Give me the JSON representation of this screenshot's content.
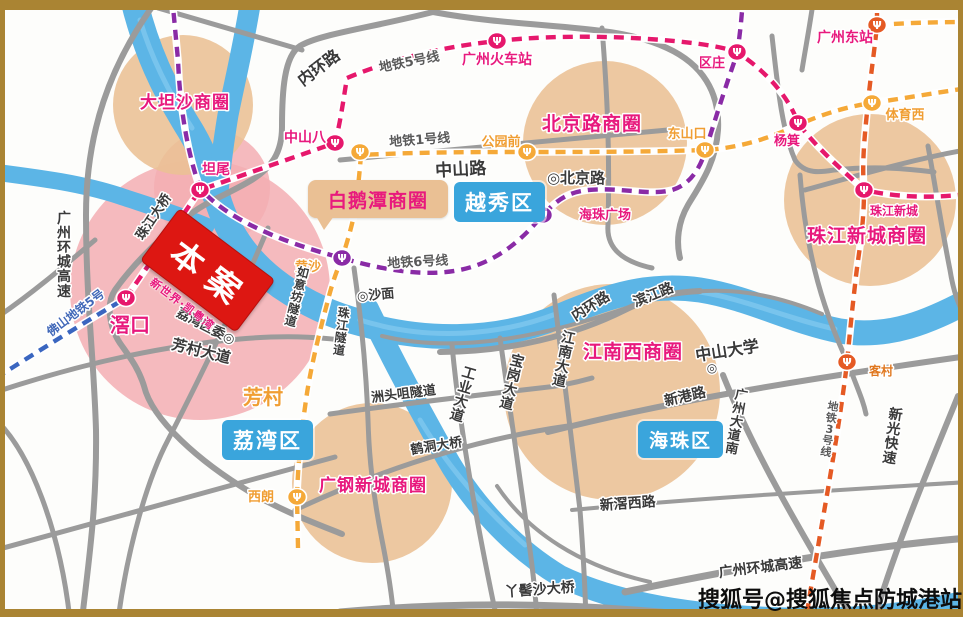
{
  "map": {
    "title_note": "Guangzhou area business-circle location map",
    "watermark": "搜狐号@搜狐焦点防城港站",
    "colors": {
      "frame": "#aa8433",
      "river": "#5cb5e6",
      "river_hi": "#85cbf0",
      "road": "#9b9b9b",
      "circle_tan": "#eac094",
      "circle_pink": "#f3aeb3",
      "pink": "#e8197d",
      "orange": "#f09e33",
      "dorange": "#e07820",
      "blue": "#4168b8",
      "dark": "#3a3a3a",
      "gray": "#5a5a5a",
      "district_box": "#3aa5dc",
      "bubble_tan": "#eac094",
      "project_red": "#dd1712",
      "line1": "#f5a938",
      "line3": "#e55a24",
      "line5": "#e6186c",
      "line6": "#8a2ba6",
      "foshan5": "#3a66c0"
    },
    "project": {
      "label": "本案",
      "sub_label": "新世界·凯粤湾"
    },
    "bubble": {
      "label": "白鹅潭商圈"
    },
    "districts": [
      {
        "label": "越秀区"
      },
      {
        "label": "荔湾区"
      },
      {
        "label": "海珠区"
      }
    ],
    "business_circles": [
      {
        "name": "大坦沙商圈",
        "cx": 183,
        "cy": 105,
        "r": 70,
        "tx": 185,
        "ty": 108,
        "fs": 17
      },
      {
        "name": "北京路商圈",
        "cx": 605,
        "cy": 143,
        "r": 82,
        "tx": 592,
        "ty": 130,
        "fs": 19
      },
      {
        "name": "珠江新城商圈",
        "cx": 870,
        "cy": 200,
        "r": 86,
        "tx": 867,
        "ty": 242,
        "fs": 19
      },
      {
        "name": "江南西商圈",
        "cx": 612,
        "cy": 392,
        "r": 108,
        "tx": 633,
        "ty": 358,
        "fs": 19
      },
      {
        "name": "广钢新城商圈",
        "cx": 372,
        "cy": 483,
        "r": 80,
        "tx": 373,
        "ty": 491,
        "fs": 17
      }
    ],
    "pink_zones": [
      {
        "name": "project-zone",
        "cx": 200,
        "cy": 290,
        "r": 130
      },
      {
        "name": "tanwei-zone",
        "cx": 212,
        "cy": 188,
        "r": 58
      }
    ],
    "stations": [
      {
        "name": "滘口",
        "x": 126,
        "y": 298,
        "c": "line5"
      },
      {
        "name": "坦尾",
        "x": 200,
        "y": 190,
        "c": "line5"
      },
      {
        "name": "中山八",
        "x": 335,
        "y": 143,
        "c": "line5"
      },
      {
        "name": "广州火车站",
        "x": 497,
        "y": 41,
        "c": "line5"
      },
      {
        "name": "区庄",
        "x": 737,
        "y": 52,
        "c": "line5"
      },
      {
        "name": "杨箕",
        "x": 798,
        "y": 123,
        "c": "line5"
      },
      {
        "name": "珠江新城",
        "x": 864,
        "y": 190,
        "c": "line5"
      },
      {
        "name": "公园前",
        "x": 527,
        "y": 152,
        "c": "line1"
      },
      {
        "name": "长寿路",
        "x": 360,
        "y": 152,
        "c": "line1"
      },
      {
        "name": "东山口",
        "x": 705,
        "y": 150,
        "c": "line1"
      },
      {
        "name": "体育西",
        "x": 872,
        "y": 103,
        "c": "line1"
      },
      {
        "name": "西朗",
        "x": 297,
        "y": 497,
        "c": "line1"
      },
      {
        "name": "黄沙",
        "x": 342,
        "y": 258,
        "c": "line6"
      },
      {
        "name": "海珠广场",
        "x": 543,
        "y": 215,
        "c": "line6"
      },
      {
        "name": "广州东站",
        "x": 877,
        "y": 25,
        "c": "line3"
      },
      {
        "name": "客村",
        "x": 847,
        "y": 362,
        "c": "line3"
      }
    ],
    "labels": [
      {
        "k": "station",
        "t": "滘口",
        "x": 130,
        "y": 332,
        "fs": 20,
        "c": "pink"
      },
      {
        "k": "station",
        "t": "坦尾",
        "x": 216,
        "y": 174,
        "fs": 14,
        "c": "pink"
      },
      {
        "k": "station",
        "t": "中山八",
        "x": 326,
        "y": 142,
        "fs": 14,
        "c": "pink",
        "a": "end"
      },
      {
        "k": "station",
        "t": "广州火车站",
        "x": 497,
        "y": 64,
        "fs": 14,
        "c": "pink"
      },
      {
        "k": "station",
        "t": "区庄",
        "x": 712,
        "y": 67,
        "fs": 13,
        "c": "pink"
      },
      {
        "k": "station",
        "t": "杨箕",
        "x": 787,
        "y": 145,
        "fs": 13,
        "c": "pink"
      },
      {
        "k": "station",
        "t": "珠江新城",
        "x": 894,
        "y": 215,
        "fs": 12,
        "c": "pink"
      },
      {
        "k": "station",
        "t": "广州东站",
        "x": 845,
        "y": 42,
        "fs": 14,
        "c": "pink"
      },
      {
        "k": "station",
        "t": "海珠广场",
        "x": 579,
        "y": 219,
        "fs": 13,
        "c": "pink",
        "a": "start"
      },
      {
        "k": "station",
        "t": "公园前",
        "x": 501,
        "y": 146,
        "fs": 13,
        "c": "orange"
      },
      {
        "k": "station",
        "t": "东山口",
        "x": 687,
        "y": 138,
        "fs": 13,
        "c": "orange"
      },
      {
        "k": "station",
        "t": "体育西",
        "x": 905,
        "y": 119,
        "fs": 13,
        "c": "orange"
      },
      {
        "k": "station",
        "t": "西朗",
        "x": 274,
        "y": 501,
        "fs": 13,
        "c": "orange",
        "a": "end"
      },
      {
        "k": "station",
        "t": "黄沙",
        "x": 321,
        "y": 271,
        "fs": 13,
        "c": "orange",
        "a": "end"
      },
      {
        "k": "station",
        "t": "客村",
        "x": 869,
        "y": 375,
        "fs": 12,
        "c": "dorange",
        "a": "start"
      },
      {
        "k": "area",
        "t": "芳村",
        "x": 263,
        "y": 404,
        "fs": 20,
        "c": "orange"
      },
      {
        "k": "road",
        "t": "内环路",
        "x": 322,
        "y": 72,
        "r": -37,
        "fs": 16
      },
      {
        "k": "road",
        "t": "中山路",
        "x": 461,
        "y": 175,
        "r": -3,
        "fs": 17
      },
      {
        "k": "road",
        "t": "珠江大桥",
        "x": 157,
        "y": 219,
        "r": -56,
        "fs": 13
      },
      {
        "k": "road",
        "t": "广州环城高速",
        "x": 64,
        "y": 258,
        "v": 1,
        "fs": 14
      },
      {
        "k": "road",
        "t": "如意坊隧道",
        "x": 296,
        "y": 300,
        "v": 1,
        "r": 14,
        "fs": 12
      },
      {
        "k": "road",
        "t": "珠江隧道",
        "x": 341,
        "y": 335,
        "v": 1,
        "r": 7,
        "fs": 12
      },
      {
        "k": "road",
        "t": "芳村大道",
        "x": 200,
        "y": 356,
        "r": 14,
        "fs": 15
      },
      {
        "k": "road",
        "t": "洲头咀隧道",
        "x": 404,
        "y": 398,
        "r": -7,
        "fs": 13
      },
      {
        "k": "road",
        "t": "工业大道",
        "x": 462,
        "y": 398,
        "v": 1,
        "r": 16,
        "fs": 14
      },
      {
        "k": "road",
        "t": "宝岗大道",
        "x": 511,
        "y": 386,
        "v": 1,
        "r": 14,
        "fs": 14
      },
      {
        "k": "road",
        "t": "江南大道",
        "x": 563,
        "y": 363,
        "v": 1,
        "r": 12,
        "fs": 14
      },
      {
        "k": "road",
        "t": "内环路",
        "x": 593,
        "y": 310,
        "r": -32,
        "fs": 14
      },
      {
        "k": "road",
        "t": "滨江路",
        "x": 655,
        "y": 299,
        "r": -22,
        "fs": 14
      },
      {
        "k": "road",
        "t": "新港路",
        "x": 686,
        "y": 401,
        "r": -13,
        "fs": 14
      },
      {
        "k": "road",
        "t": "广州大道南",
        "x": 736,
        "y": 425,
        "v": 1,
        "r": 10,
        "fs": 13
      },
      {
        "k": "road",
        "t": "新光快速",
        "x": 892,
        "y": 440,
        "v": 1,
        "r": 8,
        "fs": 14
      },
      {
        "k": "road",
        "t": "新滘西路",
        "x": 628,
        "y": 508,
        "r": -4,
        "fs": 14
      },
      {
        "k": "road",
        "t": "广州环城高速",
        "x": 761,
        "y": 572,
        "r": -7,
        "fs": 14
      },
      {
        "k": "road",
        "t": "丫髻沙大桥",
        "x": 540,
        "y": 594,
        "r": -4,
        "fs": 14
      },
      {
        "k": "road",
        "t": "鹤洞大桥",
        "x": 437,
        "y": 450,
        "r": -9,
        "fs": 13
      },
      {
        "k": "landmark",
        "t": "◎北京路",
        "x": 576,
        "y": 183,
        "fs": 15
      },
      {
        "k": "landmark",
        "t": "◎沙面",
        "x": 376,
        "y": 299,
        "r": -5,
        "fs": 13
      },
      {
        "k": "landmark",
        "t": "荔湾区委◎",
        "x": 204,
        "y": 330,
        "r": 27,
        "fs": 13
      },
      {
        "k": "landmark",
        "t": "中山大学",
        "x": 728,
        "y": 356,
        "r": -9,
        "fs": 16
      },
      {
        "k": "landmark",
        "t": "◎",
        "x": 712,
        "y": 372,
        "fs": 12
      },
      {
        "k": "metro-line",
        "t": "地铁5号线",
        "x": 410,
        "y": 66,
        "r": -11,
        "fs": 13,
        "c": "gray"
      },
      {
        "k": "metro-line",
        "t": "地铁1号线",
        "x": 420,
        "y": 144,
        "r": -4,
        "fs": 13,
        "c": "gray"
      },
      {
        "k": "metro-line",
        "t": "地铁6号线",
        "x": 418,
        "y": 266,
        "r": -3,
        "fs": 13,
        "c": "gray"
      },
      {
        "k": "metro-line",
        "t": "地铁3号线",
        "x": 829,
        "y": 432,
        "v": 1,
        "r": 9,
        "fs": 11,
        "c": "gray"
      },
      {
        "k": "metro-line",
        "t": "佛山地铁5号",
        "x": 78,
        "y": 316,
        "r": -37,
        "fs": 12,
        "c": "blue"
      }
    ]
  }
}
